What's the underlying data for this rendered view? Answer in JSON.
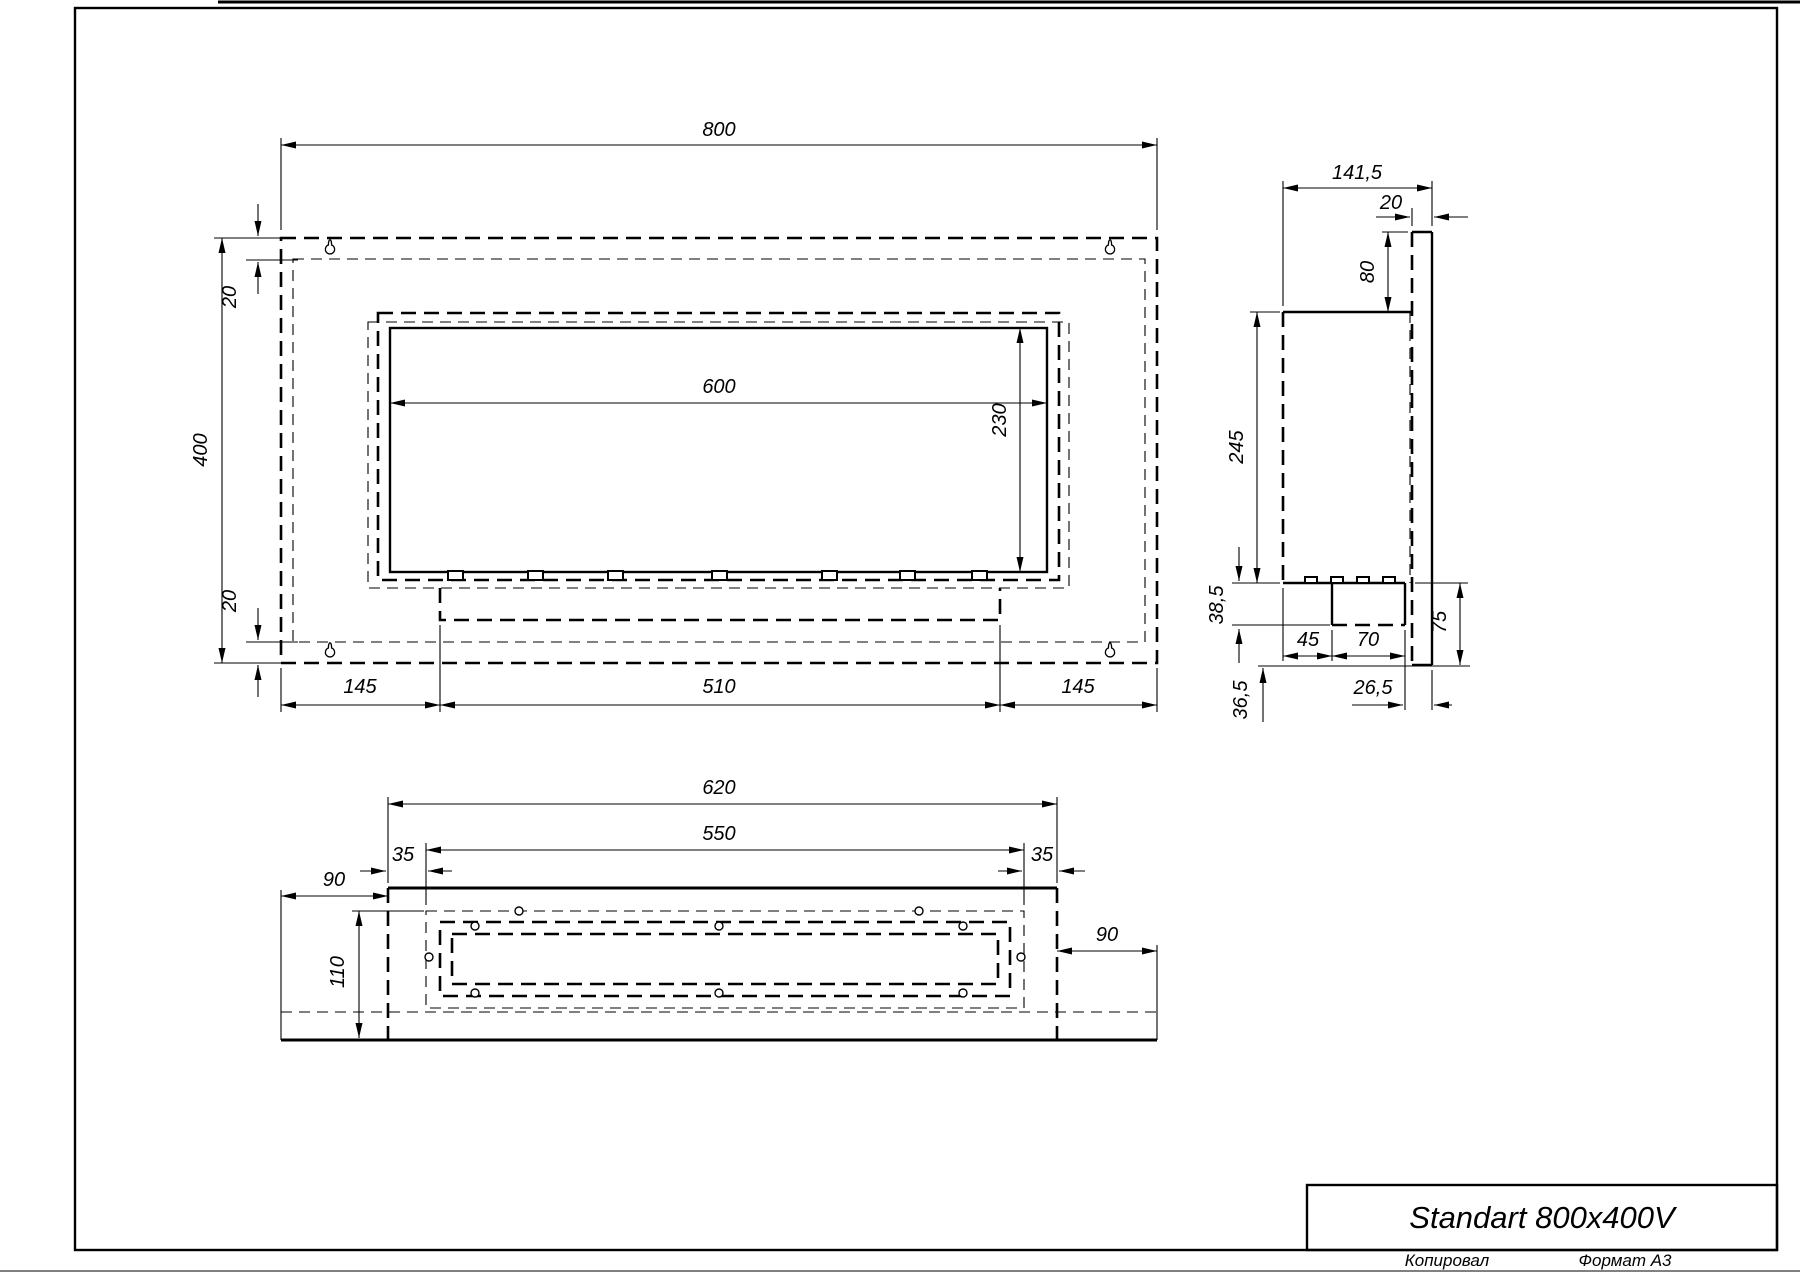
{
  "sheet": {
    "title": "Standart 800x400V",
    "copied_label": "Копировал",
    "format_label": "Формат А3"
  },
  "front_view": {
    "overall_width": "800",
    "overall_height": "400",
    "top_flange": "20",
    "bottom_flange": "20",
    "opening_width": "600",
    "opening_height": "230",
    "left_offset": "145",
    "tray_width": "510",
    "right_offset": "145"
  },
  "side_view": {
    "overall_depth": "141,5",
    "plate_thickness": "20",
    "top_overhang": "80",
    "body_height": "245",
    "tray_depth": "38,5",
    "tray_offset": "45",
    "tray_width": "70",
    "bottom_overhang": "36,5",
    "rear_gap": "26,5",
    "bracket_height": "75"
  },
  "bottom_view": {
    "body_width": "620",
    "mount_span": "550",
    "mount_inset_left": "35",
    "mount_inset_right": "35",
    "left_overhang": "90",
    "right_overhang": "90",
    "body_depth": "110"
  }
}
